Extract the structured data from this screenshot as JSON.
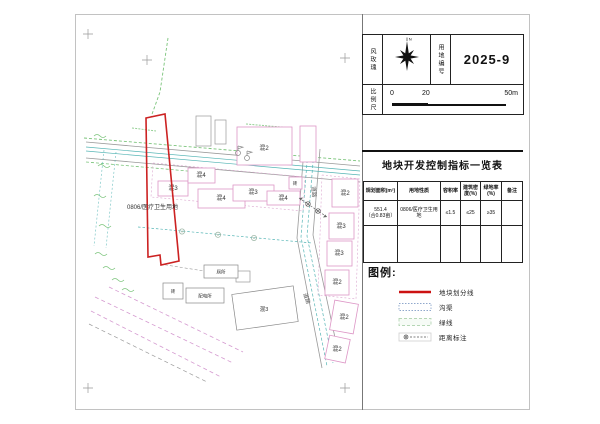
{
  "titleblock": {
    "wind_rose_label": "风玫瑰",
    "north_label": "N",
    "plot_no_label": "用地编号",
    "plot_no_value": "2025-9",
    "scale_label": "比例尺",
    "scale_tick_0": "0",
    "scale_tick_20": "20",
    "scale_tick_50": "50m"
  },
  "indicators": {
    "title": "地块开发控制指标一览表",
    "headers": [
      "规划面积(m²)",
      "用地性质",
      "容积率",
      "建筑密度(%)",
      "绿地率(%)",
      "备注"
    ],
    "row": [
      "551.4\n（合0.83亩）",
      "0806/医疗卫生用地",
      "≤1.5",
      "≤25",
      "≥35",
      ""
    ]
  },
  "legend": {
    "title": "图例:",
    "items": [
      {
        "label": "地块划分线"
      },
      {
        "label": "沟渠"
      },
      {
        "label": "绿线"
      },
      {
        "label": "距离标注"
      }
    ]
  },
  "map": {
    "parcel_label": "0806/医疗卫生用地",
    "labels": [
      "混2",
      "混3",
      "混4",
      "混4",
      "混3",
      "混4",
      "砖",
      "混2",
      "混3",
      "混3",
      "混2",
      "混2",
      "混2",
      "厕所",
      "配电所",
      "砖",
      "混3",
      "道路",
      "道路"
    ]
  },
  "colors": {
    "parcel_line": "#cc2222",
    "building_line": "#dd96c6",
    "ditch_line": "#55b5b5",
    "green_line": "#7bc47b"
  }
}
